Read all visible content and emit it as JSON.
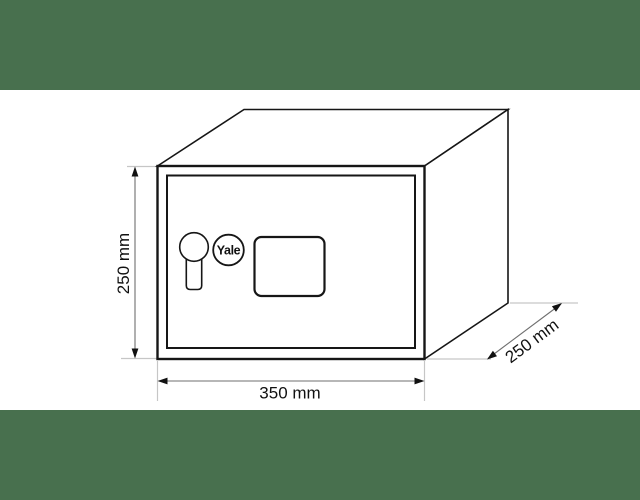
{
  "colors": {
    "banner_green": "#48704e",
    "background": "#ffffff",
    "outline": "#161616",
    "dimension_line": "#6f6f6f",
    "extension_line": "#c6c6c6",
    "label_text": "#111111"
  },
  "figure": {
    "type": "technical-drawing",
    "subject": "Yale safe isometric dimensional drawing",
    "brand": {
      "label": "Yale"
    },
    "components": [
      "keyhole",
      "yale-logo",
      "keypad-panel",
      "door-frame"
    ],
    "dimensions": {
      "height": {
        "label": "250 mm",
        "value": 250,
        "unit": "mm"
      },
      "width": {
        "label": "350 mm",
        "value": 350,
        "unit": "mm"
      },
      "depth": {
        "label": "250 mm",
        "value": 250,
        "unit": "mm"
      }
    }
  }
}
